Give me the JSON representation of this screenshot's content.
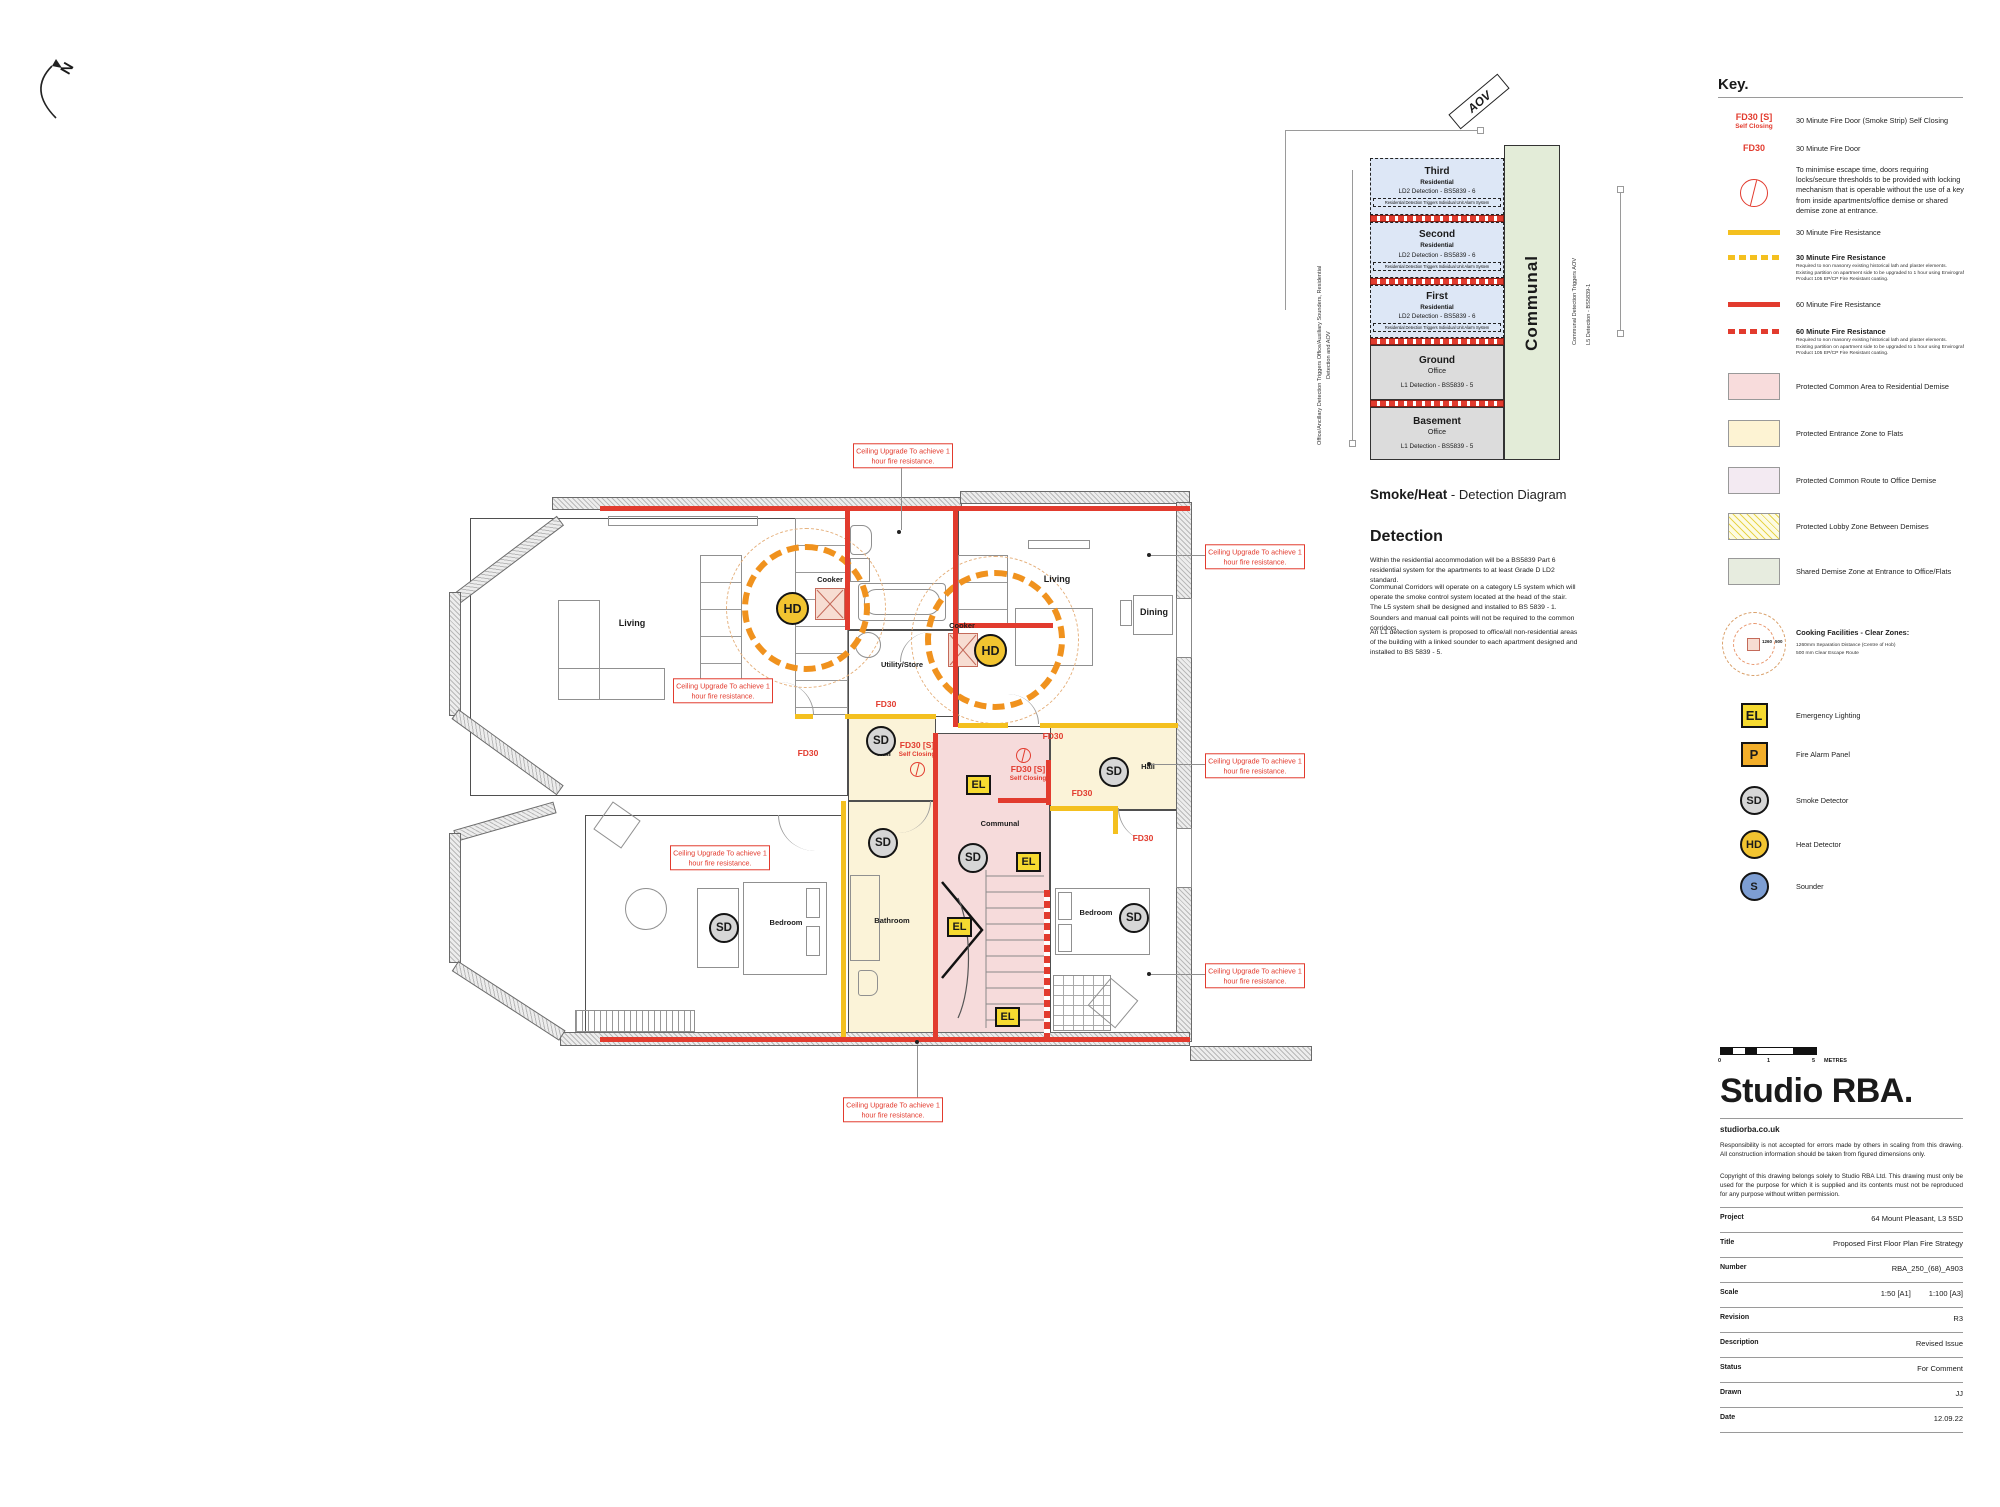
{
  "north": {
    "label": "N"
  },
  "plan": {
    "rooms": {
      "living_left": "Living",
      "living_right": "Living",
      "dining": "Dining",
      "utility": "Utility/Store",
      "hall_left": "Hall",
      "hall_right": "Hall",
      "bedroom_left": "Bedroom",
      "bedroom_right": "Bedroom",
      "bathroom": "Bathroom",
      "communal": "Communal",
      "cooker_left": "Cooker",
      "cooker_right": "Cooker"
    },
    "fd": {
      "fd30": "FD30",
      "fd30s": "FD30 [S]",
      "self_closing": "Self Closing"
    },
    "badges": {
      "sd": "SD",
      "hd": "HD",
      "el": "EL"
    },
    "ceiling_note": "Ceiling Upgrade To achieve 1 hour fire resistance."
  },
  "diagram": {
    "title_bold": "Smoke/Heat",
    "title_tail": " - Detection Diagram",
    "aov": "AOV",
    "communal": "Communal",
    "left_note": "Office/Ancillary Detection Triggers Office/Auxiliary Sounders, Residential Detection and AOV",
    "right_note_1": "Communal Detection Triggers AOV",
    "right_note_2": "L5 Detection - BS5839-1",
    "floors": [
      {
        "name": "Third",
        "use": "Residential",
        "detection": "LD2 Detection - BS5839 - 6",
        "note": "Residential Detection Triggers Individual Unit Alarm System"
      },
      {
        "name": "Second",
        "use": "Residential",
        "detection": "LD2 Detection - BS5839 - 6",
        "note": "Residential Detection Triggers Individual Unit Alarm System"
      },
      {
        "name": "First",
        "use": "Residential",
        "detection": "LD2 Detection - BS5839 - 6",
        "note": "Residential Detection Triggers Individual Unit Alarm System"
      },
      {
        "name": "Ground",
        "use": "Office",
        "detection": "L1 Detection - BS5839 - 5"
      },
      {
        "name": "Basement",
        "use": "Office",
        "detection": "L1 Detection - BS5839 - 5"
      }
    ]
  },
  "detection_text": {
    "heading": "Detection",
    "p1": "Within the residential accommodation will be a BS5839 Part 6 residential system for the apartments to at least Grade D LD2 standard.",
    "p2": "Communal Corridors will operate on a category L5 system which will operate the smoke control system located at the head of the stair. The L5 system shall be designed and installed to BS 5839 - 1. Sounders and manual call points will not be required to the common corridors.",
    "p3": "An L1 detection system is proposed to office/all non-residential areas of the building with a linked sounder to each apartment designed and installed to BS 5839 - 5."
  },
  "key": {
    "title": "Key.",
    "items": [
      {
        "symbol": "FD30 [S]",
        "symbol2": "Self Closing",
        "label": "30 Minute Fire Door (Smoke Strip) Self Closing"
      },
      {
        "symbol": "FD30",
        "label": "30 Minute Fire Door"
      },
      {
        "label": "To minimise escape time, doors requiring locks/secure thresholds to be provided with locking mechanism that is operable without the use of a key from inside apartments/office demise or shared demise zone at entrance."
      },
      {
        "label": "30 Minute Fire Resistance"
      },
      {
        "label": "30 Minute Fire Resistance",
        "note": "Required to non masonry existing historical lath and plaster elements. Existing partition on apartment side to be upgraded to 1 hour using Envirograf Product 105 EP/CP Fire Resistant coating."
      },
      {
        "label": "60 Minute Fire Resistance"
      },
      {
        "label": "60 Minute Fire Resistance",
        "note": "Required to non masonry existing historical lath and plaster elements. Existing partition on apartment side to be upgraded to 1 hour using Envirograf Product 105 EP/CP Fire Resistant coating."
      },
      {
        "label": "Protected Common Area to Residential Demise"
      },
      {
        "label": "Protected Entrance Zone to Flats"
      },
      {
        "label": "Protected Common Route to Office Demise"
      },
      {
        "label": "Protected Lobby Zone Between Demises"
      },
      {
        "label": "Shared Demise Zone at Entrance to Office/Flats"
      },
      {
        "label": "Cooking Facilities - Clear Zones:",
        "note1": "1260mm Separation Distance (Centre of Hob)",
        "note2": "500 mm Clear Escape Route",
        "dim1": "1260",
        "dim2": "500"
      },
      {
        "symbol": "EL",
        "label": "Emergency Lighting"
      },
      {
        "symbol": "P",
        "label": "Fire Alarm Panel"
      },
      {
        "symbol": "SD",
        "label": "Smoke Detector"
      },
      {
        "symbol": "HD",
        "label": "Heat Detector"
      },
      {
        "symbol": "S",
        "label": "Sounder"
      }
    ]
  },
  "title_block": {
    "brand": "Studio RBA.",
    "website": "studiorba.co.uk",
    "disclaimer1": "Responsibility is not accepted for errors made by others in scaling from this drawing. All construction information should be taken from figured dimensions only.",
    "disclaimer2": "Copyright of this drawing belongs solely to Studio RBA Ltd. This drawing must only be used for the purpose for which it is supplied and its contents must not be reproduced for any purpose without written permission.",
    "scale_bar": {
      "tick0": "0",
      "tick1": "1",
      "tick2": "5",
      "unit": "METRES"
    },
    "rows": [
      {
        "label": "Project",
        "value": "64 Mount Pleasant, L3 5SD"
      },
      {
        "label": "Title",
        "value": "Proposed First Floor Plan Fire Strategy"
      },
      {
        "label": "Number",
        "value": "RBA_250_(68)_A903"
      },
      {
        "label": "Scale",
        "value": "1:50 [A1]",
        "value2": "1:100 [A3]"
      },
      {
        "label": "Revision",
        "value": "R3"
      },
      {
        "label": "Description",
        "value": "Revised Issue"
      },
      {
        "label": "Status",
        "value": "For Comment"
      },
      {
        "label": "Drawn",
        "value": "JJ"
      },
      {
        "label": "Date",
        "value": "12.09.22"
      }
    ]
  },
  "colors": {
    "fire_red": "#e23b2e",
    "fire_yellow": "#f4c01f",
    "cook_orange": "#f0921e",
    "pink_zone": "#f6dbdb",
    "cream_zone": "#fbf3d8",
    "lilac_zone": "#f3eaf2",
    "green_zone": "#e7ecdf",
    "blue_floor": "#dde7f6",
    "grey_floor": "#dcdcdc",
    "el_yellow": "#f6da30",
    "panel_orange": "#f2ae2a",
    "hd_yellow": "#f2c430",
    "sd_grey": "#d6d6d6",
    "sounder_blue": "#7d9ed3"
  }
}
